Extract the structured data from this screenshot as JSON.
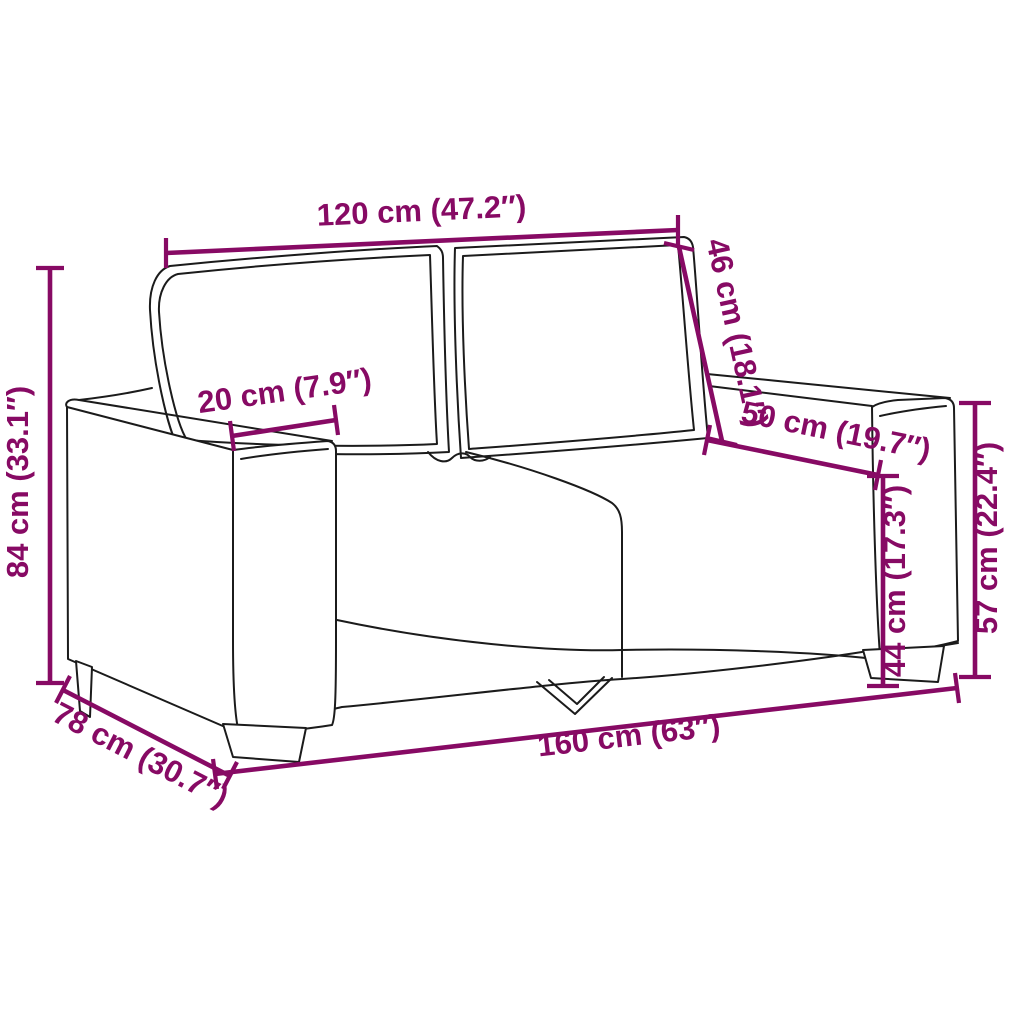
{
  "diagram": {
    "product": "2-seater sofa dimension drawing",
    "background_color": "#ffffff",
    "line_art_color": "#1b1b1b",
    "dimension_color": "#870a64",
    "dimensions": [
      {
        "id": "backrest-width",
        "label": "120 cm (47.2″)",
        "cm": "120",
        "inches": "47.2"
      },
      {
        "id": "backrest-height",
        "label": "46 cm (18.1″)",
        "cm": "46",
        "inches": "18.1"
      },
      {
        "id": "total-height",
        "label": "84 cm (33.1″)",
        "cm": "84",
        "inches": "33.1"
      },
      {
        "id": "armrest-width",
        "label": "20 cm (7.9″)",
        "cm": "20",
        "inches": "7.9"
      },
      {
        "id": "seat-depth",
        "label": "50 cm (19.7″)",
        "cm": "50",
        "inches": "19.7"
      },
      {
        "id": "seat-height",
        "label": "44 cm (17.3″)",
        "cm": "44",
        "inches": "17.3"
      },
      {
        "id": "armrest-height",
        "label": "57 cm (22.4″)",
        "cm": "57",
        "inches": "22.4"
      },
      {
        "id": "total-width",
        "label": "160 cm (63″)",
        "cm": "160",
        "inches": "63"
      },
      {
        "id": "total-depth",
        "label": "78 cm (30.7″)",
        "cm": "78",
        "inches": "30.7"
      }
    ]
  }
}
